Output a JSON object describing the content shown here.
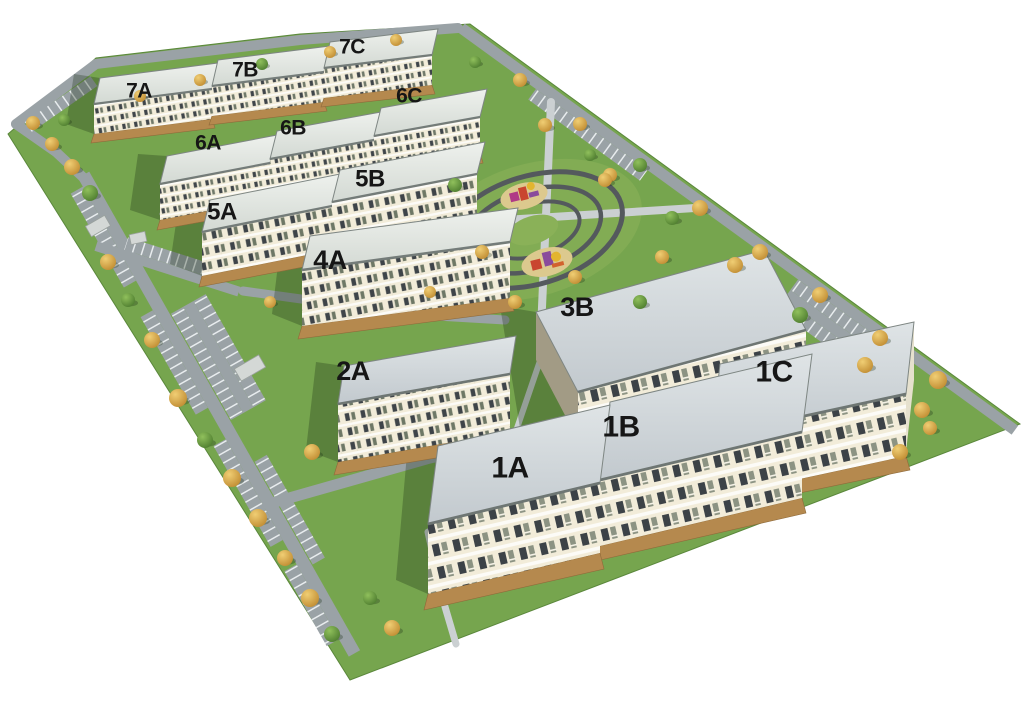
{
  "scene": {
    "type": "aerial-3d-site-plan-rendering",
    "description": "Axonometric rendering of a residential estate master plan with labeled apartment building sections, perimeter roads with parking bays, autumn trees and a central oval playground park",
    "background_color": "#ffffff"
  },
  "buildings": [
    {
      "id": "7A",
      "label": "7A"
    },
    {
      "id": "7B",
      "label": "7B"
    },
    {
      "id": "7C",
      "label": "7C"
    },
    {
      "id": "6A",
      "label": "6A"
    },
    {
      "id": "6B",
      "label": "6B"
    },
    {
      "id": "6C",
      "label": "6C"
    },
    {
      "id": "5A",
      "label": "5A"
    },
    {
      "id": "5B",
      "label": "5B"
    },
    {
      "id": "4A",
      "label": "4A"
    },
    {
      "id": "3B",
      "label": "3B"
    },
    {
      "id": "2A",
      "label": "2A"
    },
    {
      "id": "1A",
      "label": "1A"
    },
    {
      "id": "1B",
      "label": "1B"
    },
    {
      "id": "1C",
      "label": "1C"
    }
  ],
  "palette": {
    "grass": "#76a54e",
    "road": "#9aa2a6",
    "parking_line": "#e8ecee",
    "footpath": "#cbd0d2",
    "roof_far": "#e4e8e3",
    "roof_near": "#ccd3d7",
    "facade": "#f2ecd9",
    "window": "#3e4449",
    "terrace": "#b5894e",
    "tree_autumn": "#d8a44a",
    "tree_green": "#6f9d45",
    "label": "#161616",
    "playground": [
      "#c9452f",
      "#8a4b9c",
      "#e3b52f",
      "#d2622e"
    ]
  },
  "park": {
    "ring_count": 3,
    "playground_count": 2
  }
}
